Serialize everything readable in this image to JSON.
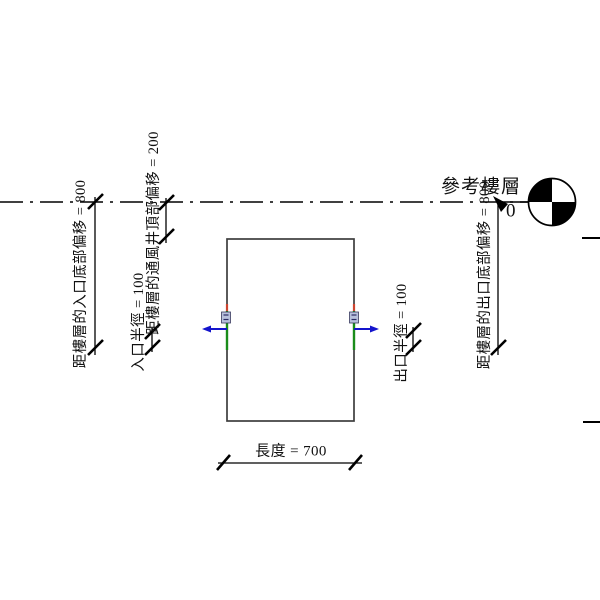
{
  "view": {
    "background": "#ffffff",
    "description": "family elevation view with vent shaft extrusion, level line and dimensions"
  },
  "level": {
    "name": "參考樓層",
    "elevation": "0"
  },
  "labels": {
    "entrance_bottom_offset": "距樓層的入口底部偏移 = 800",
    "vent_top_offset": "距樓層的通風井頂部偏移 = 200",
    "entrance_radius": "入口半徑 = 100",
    "exit_radius": "出口半徑 = 100",
    "exit_bottom_offset": "距樓層的出口底部偏移 = 800",
    "length": "長度 = 700"
  },
  "values": {
    "entrance_bottom_offset": 800,
    "vent_top_offset": 200,
    "entrance_radius": 100,
    "exit_radius": 100,
    "exit_bottom_offset": 800,
    "length": 700,
    "level_elevation": 0
  },
  "colors": {
    "annotation_black": "#000000",
    "model_outline": "#3d3d3d",
    "connector_green": "#1a8c1a",
    "flow_arrow_blue": "#1414cc",
    "connector_red": "#cc4430",
    "connector_glyph_fill": "#b8c1dd",
    "connector_glyph_stroke": "#39395e"
  },
  "icons": {
    "level_head": "quadrant-circle-icon",
    "flow_direction_left": "arrow-left-icon",
    "flow_direction_right": "arrow-right-icon",
    "dimension_tick": "slash-tick-icon"
  }
}
